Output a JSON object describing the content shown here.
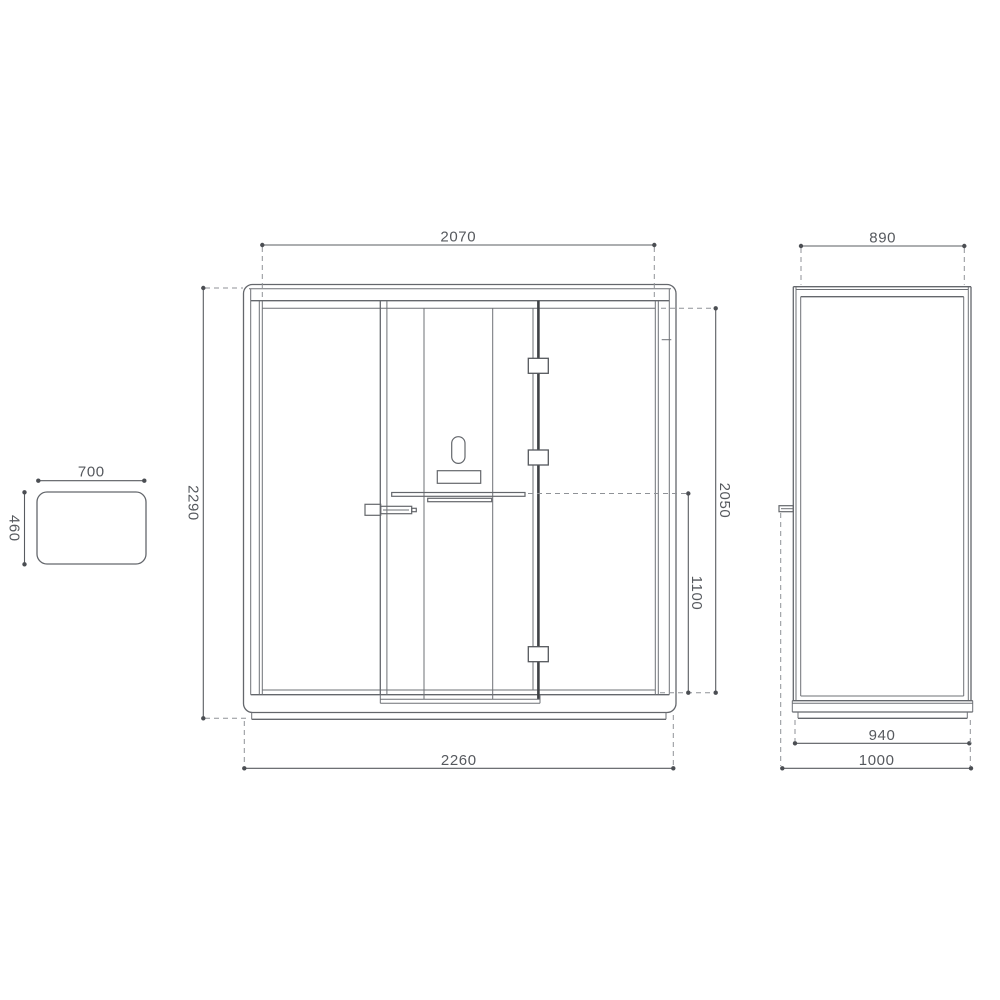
{
  "drawing": {
    "kind": "technical-dimension-drawing",
    "dimensions": {
      "table": {
        "width": "700",
        "depth": "460"
      },
      "front": {
        "opening_width": "2070",
        "overall_height": "2290",
        "overall_width": "2260",
        "right_inner_height": "2050",
        "worktop_height": "1100"
      },
      "side": {
        "top_depth": "890",
        "base_depth": "940",
        "overall_depth": "1000"
      }
    },
    "colors": {
      "background": "#ffffff",
      "body_line": "#64676c",
      "door_stile_line": "#3e4145",
      "dimension_line": "#595c61",
      "extension_dash": "#8f9297",
      "terminator_dot": "#4b4e53",
      "label_text": "#56595e"
    }
  }
}
